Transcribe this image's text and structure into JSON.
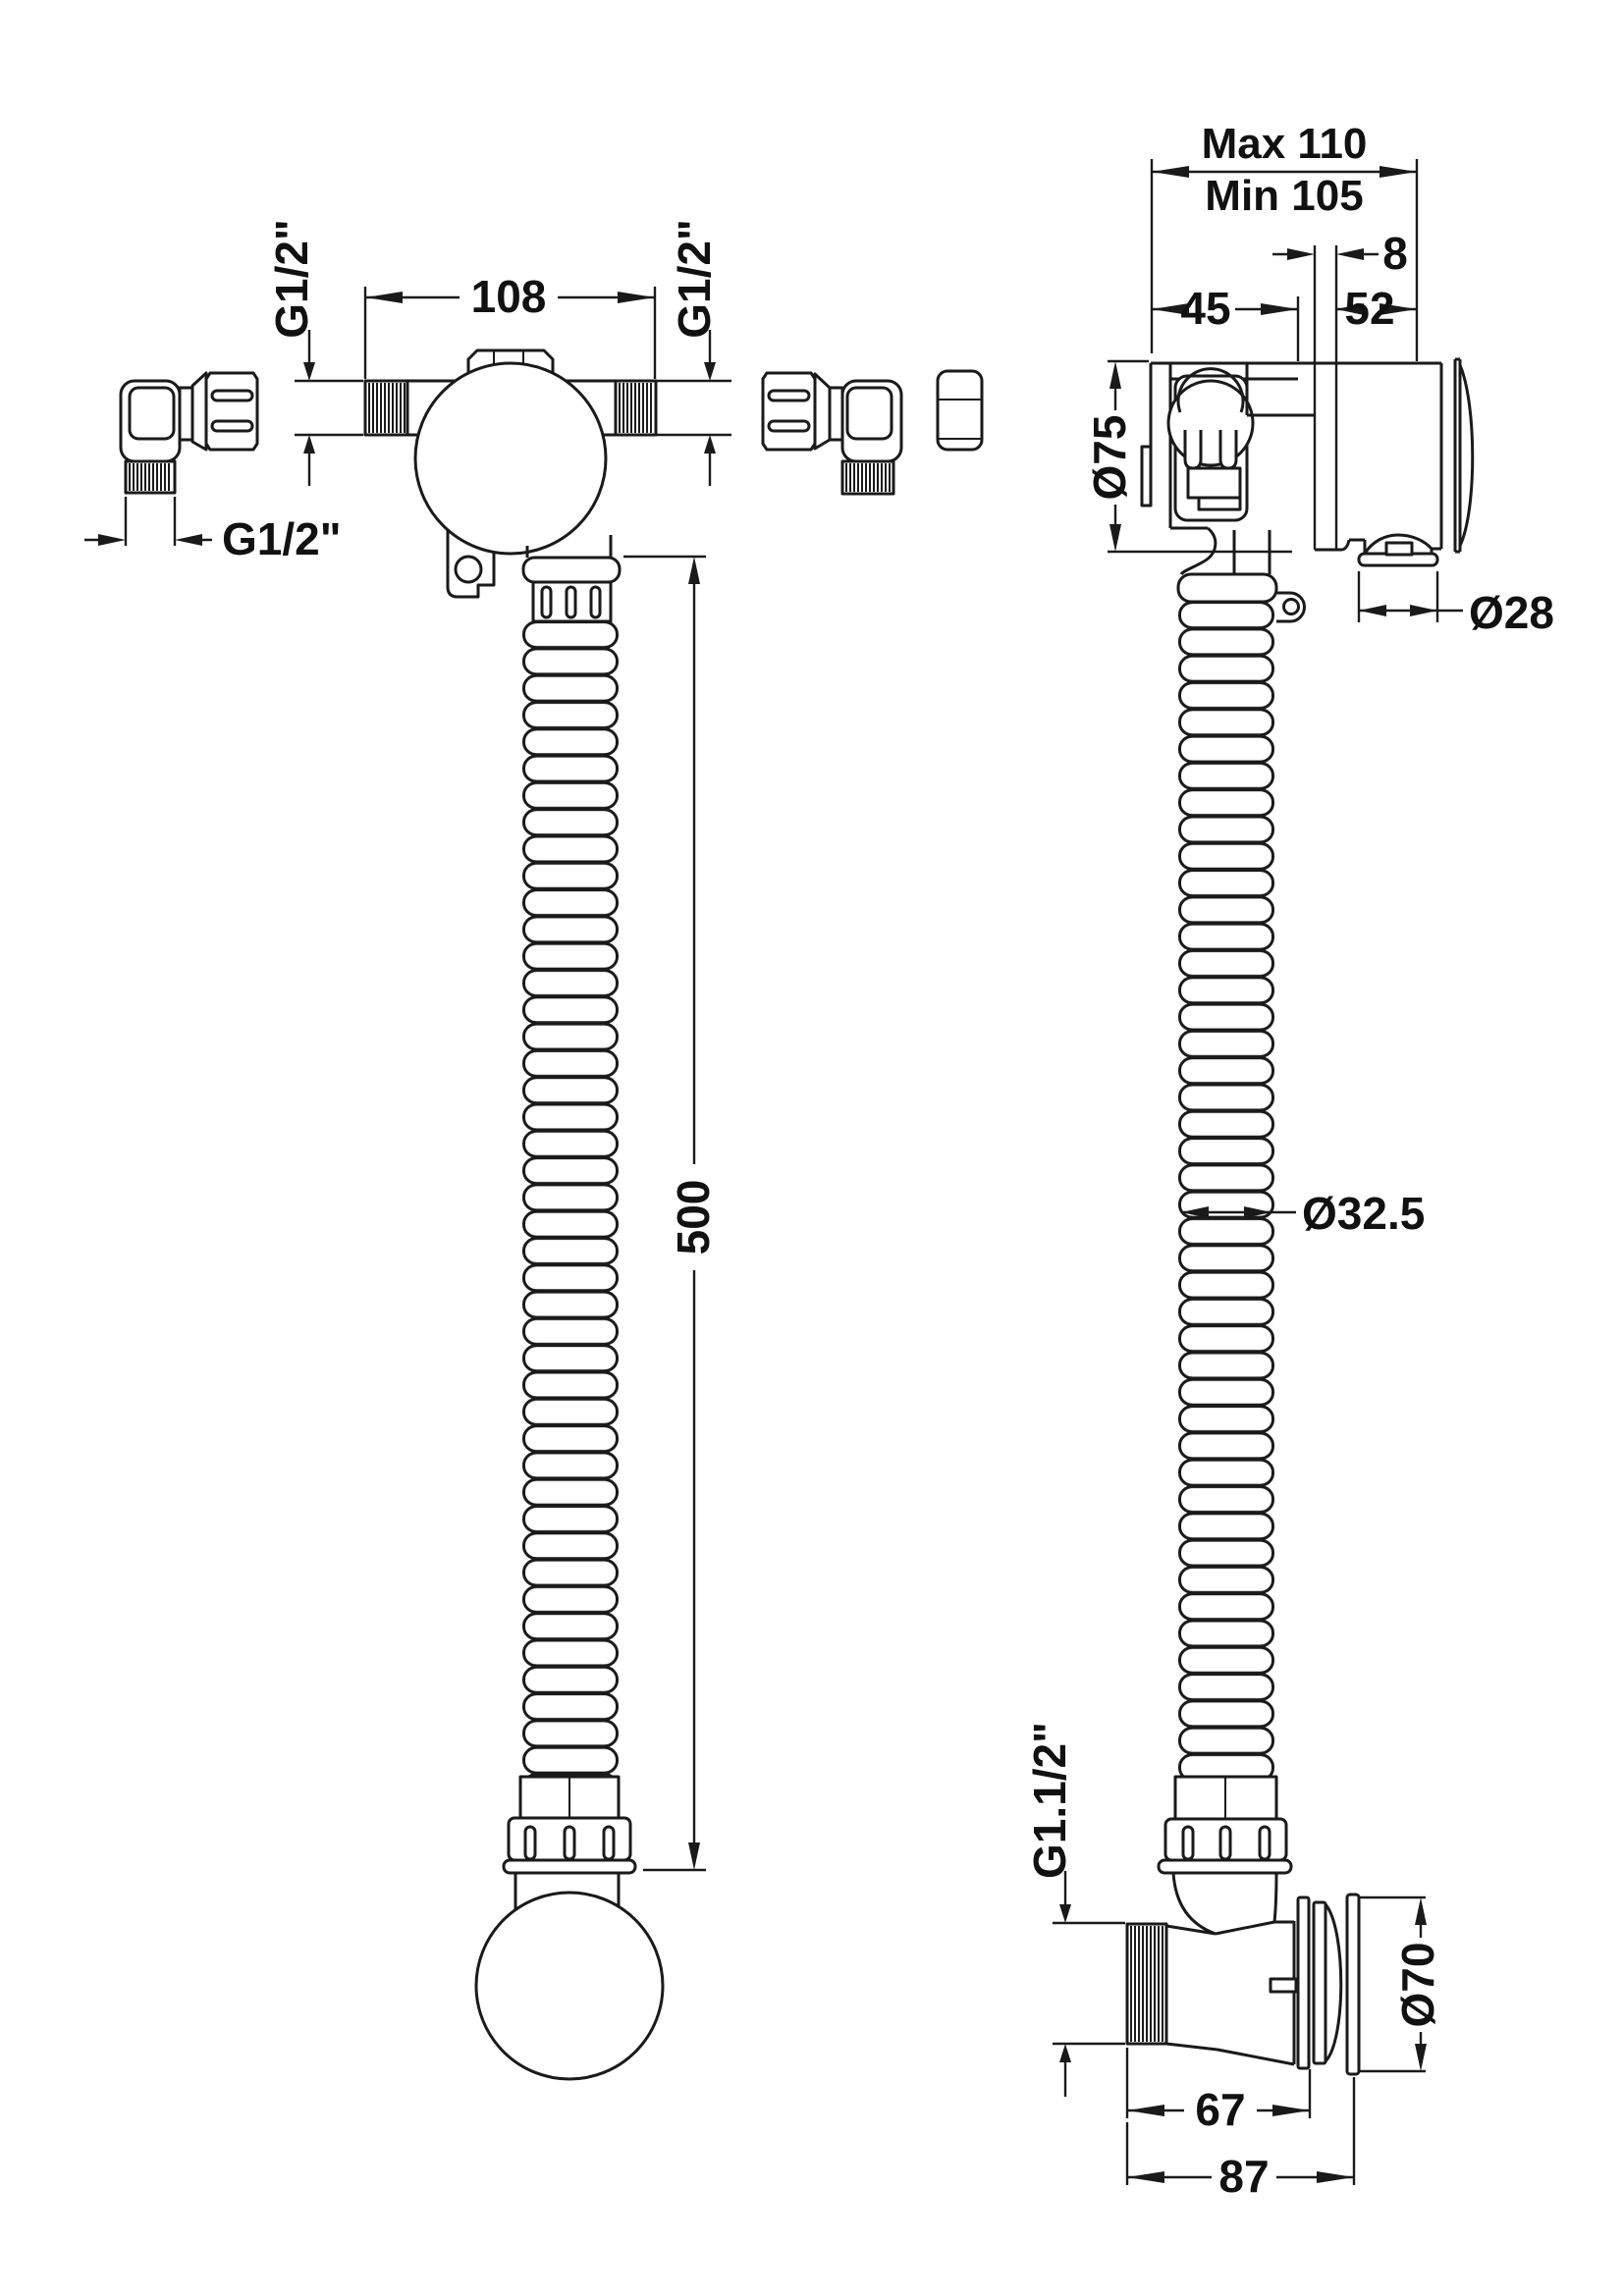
{
  "drawing": {
    "type": "technical-dimension-drawing",
    "subject": "bath-filler-overflow-waste",
    "colors": {
      "line": "#1a1a1a",
      "background": "#ffffff"
    },
    "front_view": {
      "body_width": "108",
      "inlet_thread_left": "G1/2\"",
      "inlet_thread_right": "G1/2\"",
      "elbow_thread": "G1/2\"",
      "hose_length": "500"
    },
    "side_view": {
      "depth_max": "Max 110",
      "depth_min": "Min 105",
      "plate_thickness": "8",
      "offset_front": "45",
      "offset_rear": "52",
      "body_diameter": "Ø75",
      "spigot_diameter": "Ø28",
      "hose_diameter": "Ø32.5",
      "waste_thread": "G1.1/2\"",
      "flange_diameter": "Ø70",
      "waste_body_length": "67",
      "waste_total_length": "87"
    }
  }
}
